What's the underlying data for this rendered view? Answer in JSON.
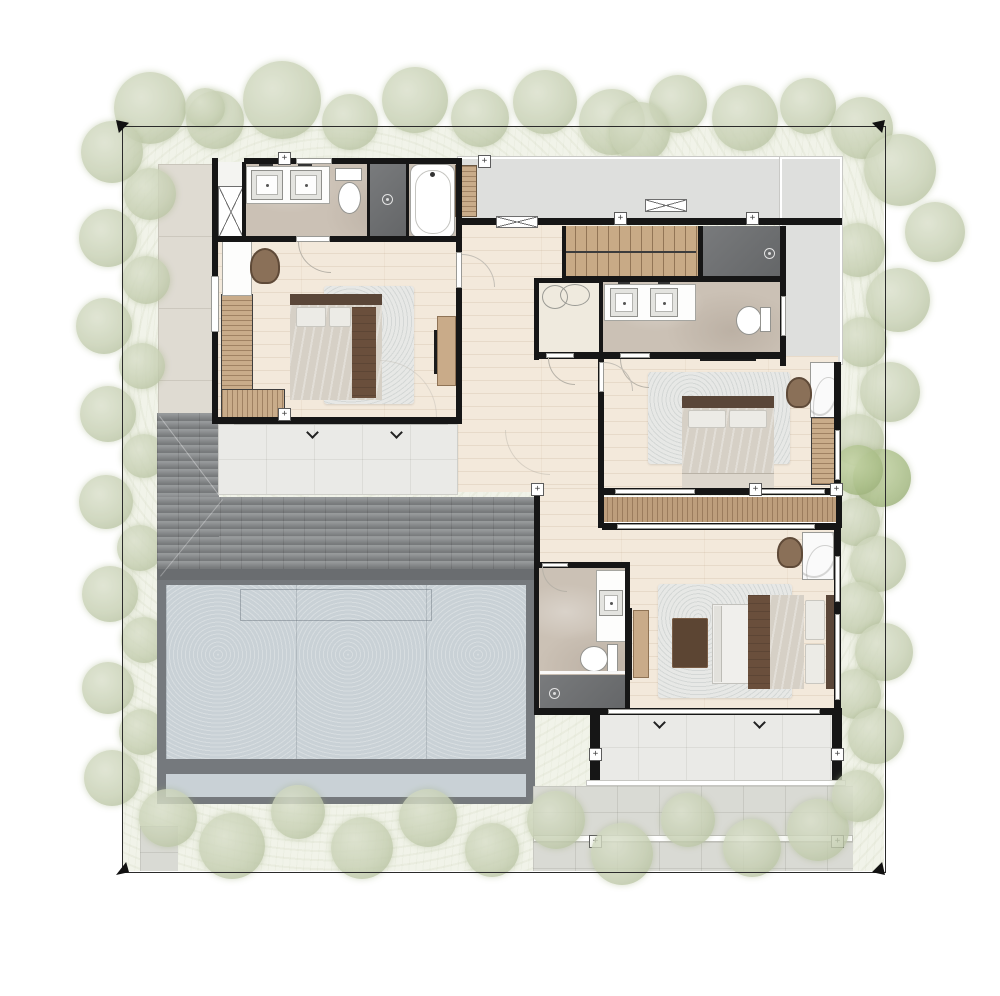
{
  "document": {
    "type": "architectural floor plan rendering",
    "description": "Top-down colored second-floor plan of a villa with landscaped site boundary",
    "visible_text": "none"
  },
  "site": {
    "boundary_style": "thin black property line with solid black corner arrows",
    "landscape": {
      "tree_color": "#c7d0b3",
      "accent_tree_color": "#a9bd87",
      "ground_cover_color": "#f1f3e9"
    }
  },
  "palette": {
    "wall": "#161616",
    "wood_floor": "#f3e9db",
    "marble_floor": "#cbc1b5",
    "white_tile": "#eaeae7",
    "paving": "#d9dad4",
    "deck_wood": "#bd9e7c",
    "stair_wood": "#c8aa86",
    "shingle_roof": "#8e9193",
    "flat_roof": "#c9d1d6",
    "roof_frame": "#75797d",
    "gray_terrace": "#dedfdd",
    "shower_dark": "#6f7173",
    "headboard_wood": "#5a4638",
    "duvet": "#d6d0c6",
    "furniture_wood": "#c9ab89"
  },
  "rooms": [
    {
      "id": "master-bathroom",
      "label": "Master bathroom with double vanity, toilet, dark shower and bathtub"
    },
    {
      "id": "linen-closet",
      "label": "Linen closet with X cabinet symbol"
    },
    {
      "id": "master-bedroom",
      "label": "Master bedroom with bed, rug, dresser, armchair, TV console and louvered stair shaft"
    },
    {
      "id": "hallway",
      "label": "Central hallway in wood flooring"
    },
    {
      "id": "staircase",
      "label": "Main staircase with wooden treads"
    },
    {
      "id": "shower-room",
      "label": "Dark tiled shower room"
    },
    {
      "id": "bathroom-2",
      "label": "Shared bathroom with double vanity and toilet"
    },
    {
      "id": "walk-in-closet",
      "label": "Walk-in closet"
    },
    {
      "id": "bedroom-2",
      "label": "Bedroom 2 with bed, rug, wardrobe, vanity desk and chair"
    },
    {
      "id": "bedroom-3",
      "label": "Bedroom 3 with bed, sofa, coffee table, TV console, desk and chair"
    },
    {
      "id": "bathroom-3",
      "label": "En-suite bathroom with vanity, toilet and dark shower"
    },
    {
      "id": "master-terrace",
      "label": "White tiled terrace off master bedroom"
    },
    {
      "id": "rear-terrace",
      "label": "White tiled rear terrace with columns"
    },
    {
      "id": "balcony-deck",
      "label": "Timber balcony deck strips"
    },
    {
      "id": "gray-roof-terrace",
      "label": "L-shaped gray roof terrace at top right"
    },
    {
      "id": "shingle-roof",
      "label": "Dark hip shingle roof over lower storey"
    },
    {
      "id": "flat-roof",
      "label": "Large blue-gray flat roof / carport below"
    }
  ],
  "fixtures": [
    "double-sink-vanity",
    "toilet",
    "bathtub",
    "shower-head",
    "bed",
    "pillows",
    "rug",
    "sofa",
    "coffee-table",
    "tv-console",
    "wardrobe",
    "desk-chair",
    "column-markers",
    "door-swing-arcs",
    "window-sills"
  ]
}
